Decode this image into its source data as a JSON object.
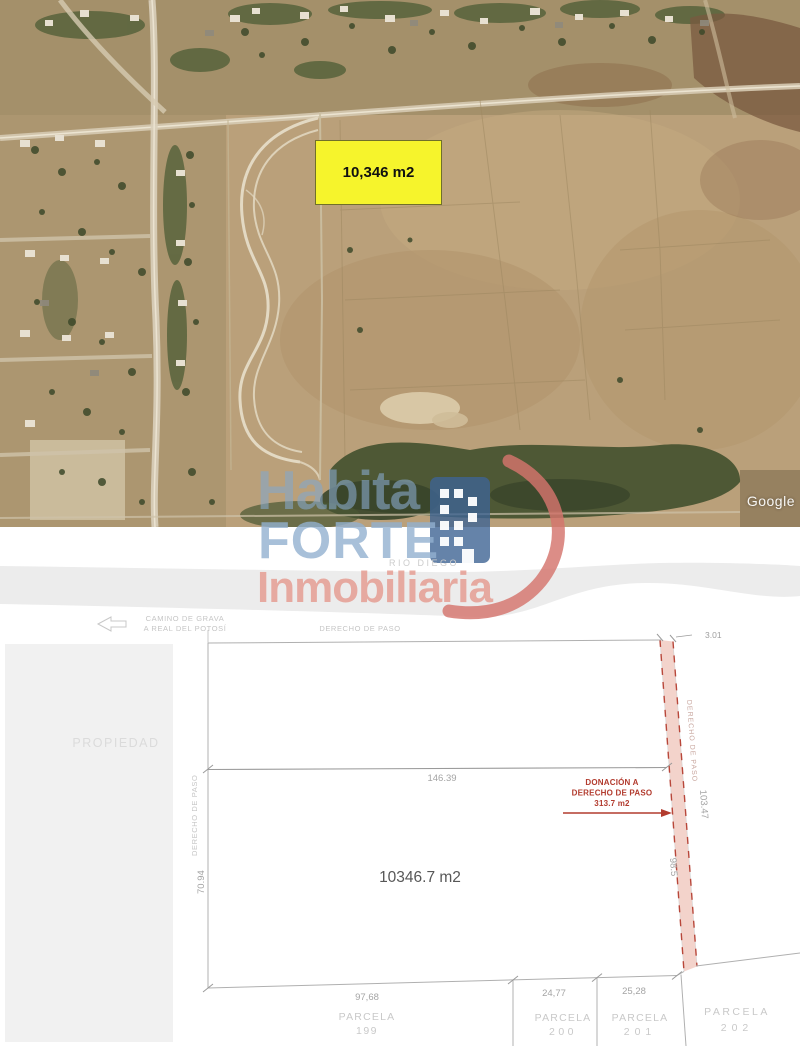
{
  "satellite": {
    "area_label": "10,346 m2",
    "attribution": "Google",
    "highlight_color": "#f6f42c"
  },
  "watermark": {
    "habita": "Habita",
    "forte": "FORTE",
    "inmobiliaria": "Inmobiliaria",
    "tagline": "RIO DIEGO",
    "blue": "#92b0cf",
    "red": "#d7958c"
  },
  "plan": {
    "road": {
      "line1": "CAMINO DE GRAVA",
      "line2": "A REAL DEL POTOSÍ"
    },
    "top_easement": "DERECHO DE PASO",
    "left_easement": "DERECHO DE PASO",
    "strip_easement": "DERECHO DE PASO",
    "property": "PROPIEDAD",
    "main_area": "10346.7 m2",
    "donation": {
      "line1": "DONACIÓN A",
      "line2": "DERECHO DE PASO",
      "line3": "313.7 m2"
    },
    "dims": {
      "divider_width": "146.39",
      "left_height": "70.94",
      "strip_top": "3.01",
      "strip_right": "103.47",
      "strip_inner": "98.5",
      "bottom_left": "97,68",
      "bottom_mid": "24,77",
      "bottom_right": "25,28"
    },
    "parcels": [
      {
        "name": "PARCELA",
        "number": "199"
      },
      {
        "name": "PARCELA",
        "number": "200"
      },
      {
        "name": "PARCELA",
        "number": "201"
      },
      {
        "name": "PARCELA",
        "number": "202"
      }
    ],
    "accent_red": "#b23b2e",
    "strip_fill": "#f2cfc6",
    "line_gray": "#b0b0b0"
  }
}
